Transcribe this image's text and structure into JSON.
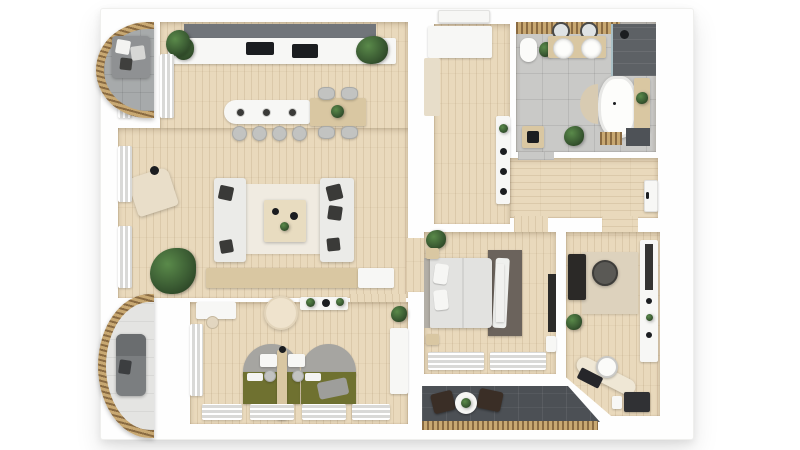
{
  "meta": {
    "title": "3D apartment floor plan (top-down render)",
    "render_style": "photoreal 3d dollhouse view",
    "visible_text": "none"
  },
  "colors": {
    "wall": "#fefefe",
    "floor-wood": "#e9d9bc",
    "floor-tile": "#c9c9c7",
    "floor-tile-dark": "#4c5055",
    "balcony-tile": "#a7aaab",
    "rail-wood-dark": "#8a6b42",
    "rail-wood-light": "#c8a872",
    "sofa-light": "#ebebe8",
    "cushion-dark": "#3a3a38",
    "bed-green": "#6f7130",
    "headboard-gray": "#a6a5a1",
    "rug-living": "#f0ebe1",
    "rug-bedroom": "#6b635c",
    "rug-office": "#ddd2bd",
    "counter-dark": "#71757a",
    "appliance-black": "#1b1d20",
    "wood-furniture": "#d9c7a2",
    "plant-green": "#3b5c33",
    "shower-dark": "#5d6165",
    "terrace-chair": "#3a2e26",
    "white-furniture": "#f7f7f5"
  },
  "rooms": [
    {
      "id": "living-kitchen",
      "name": "Open living room with kitchen",
      "floor": "light oak planks",
      "furniture": [
        "kitchen counter with cooktop and sink",
        "dark upper cabinet band",
        "kitchen island with 3 pendant lamps",
        "4 bar stools",
        "dining table",
        "4 dining chairs",
        "two facing sofas with dark cushions",
        "coffee table",
        "area rug",
        "sideboard",
        "armchair with floor lamp",
        "large monstera plant",
        "window curtains"
      ]
    },
    {
      "id": "entry-hall",
      "name": "Entry hall",
      "floor": "light oak planks",
      "furniture": [
        "entrance door",
        "wardrobe",
        "runner mat",
        "wall shelf with decor"
      ]
    },
    {
      "id": "bathroom",
      "name": "Bathroom",
      "floor": "gray tile",
      "furniture": [
        "toilet",
        "double vanity with two round sinks",
        "two round mirrors",
        "walk-in shower (dark tile)",
        "freestanding oval bathtub",
        "half-round mat",
        "wooden bench with plants",
        "wood slat mat",
        "dark mat",
        "small cabinet",
        "plants"
      ]
    },
    {
      "id": "corridor",
      "name": "Corridor",
      "floor": "light oak planks",
      "furniture": [
        "door with handle at right end"
      ]
    },
    {
      "id": "master-bedroom",
      "name": "Master bedroom",
      "floor": "light oak planks",
      "furniture": [
        "double bed with headboard",
        "two nightstands",
        "foot bench",
        "dark rug with white throw",
        "wall TV panel",
        "plant",
        "window curtains"
      ]
    },
    {
      "id": "office",
      "name": "Home office",
      "floor": "light oak planks",
      "furniture": [
        "dark desk",
        "office chair",
        "beige rug",
        "shelving unit with tall mirror",
        "curved desk along angled wall",
        "white chair",
        "dark cabinet",
        "plant"
      ]
    },
    {
      "id": "kids-bedroom",
      "name": "Kids bedroom",
      "floor": "light oak planks",
      "furniture": [
        "two olive-green beds with arched gray headboards",
        "wooden divider with two small desks and stools",
        "round cream pouf",
        "desk with chair",
        "wall shelf with plants",
        "wardrobe curtain",
        "desk at right wall with plant",
        "window curtains",
        "gray blanket"
      ]
    },
    {
      "id": "balcony-top-left",
      "name": "Curved balcony (top left)",
      "floor": "gray tile",
      "furniture": [
        "curved wood-slat railing",
        "outdoor sofa with cushions"
      ]
    },
    {
      "id": "balcony-bottom-left",
      "name": "Curved balcony (bottom left)",
      "floor": "light tile",
      "furniture": [
        "curved wood-slat railing",
        "lounge chair"
      ]
    },
    {
      "id": "terrace",
      "name": "Terrace (bottom)",
      "floor": "dark gray tile",
      "furniture": [
        "wood-slat railing",
        "two dark lounge chairs",
        "round white table with plant"
      ]
    }
  ]
}
